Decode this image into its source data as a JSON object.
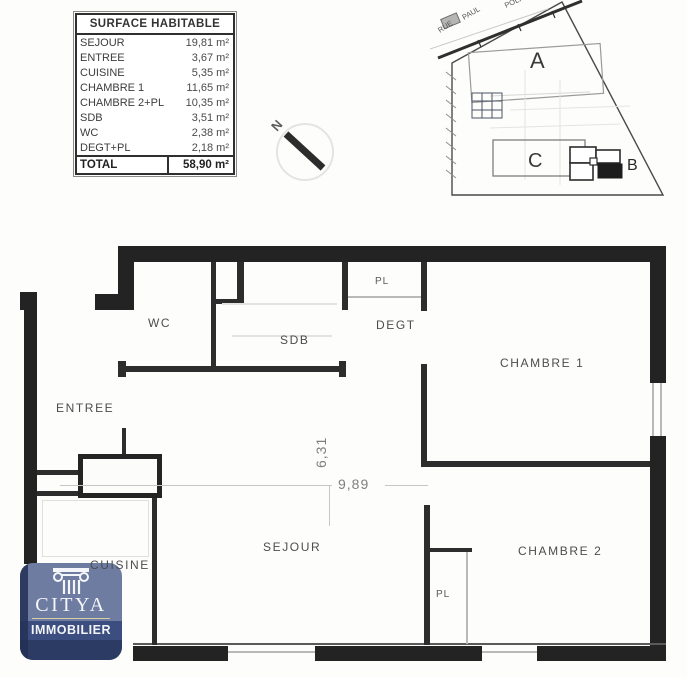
{
  "surface_table": {
    "title": "SURFACE HABITABLE",
    "rows": [
      {
        "label": "SEJOUR",
        "value": "19,81 m²"
      },
      {
        "label": "ENTREE",
        "value": "3,67 m²"
      },
      {
        "label": "CUISINE",
        "value": "5,35 m²"
      },
      {
        "label": "CHAMBRE 1",
        "value": "11,65 m²"
      },
      {
        "label": "CHAMBRE 2+PL",
        "value": "10,35 m²"
      },
      {
        "label": "SDB",
        "value": "3,51 m²"
      },
      {
        "label": "WC",
        "value": "2,38 m²"
      },
      {
        "label": "DEGT+PL",
        "value": "2,18 m²"
      }
    ],
    "total": {
      "label": "TOTAL",
      "value": "58,90 m²"
    }
  },
  "site_plan": {
    "street_words": {
      "w1": "RUE",
      "w2": "PAUL",
      "w3": "POLIO"
    },
    "building_labels": {
      "a": "A",
      "b": "B",
      "c": "C"
    }
  },
  "compass": {
    "north": "N"
  },
  "floor_plan": {
    "labels": {
      "wc": "WC",
      "sdb": "SDB",
      "pl_top": "PL",
      "degt": "DEGT",
      "chambre1": "CHAMBRE 1",
      "entree": "ENTREE",
      "sejour": "SEJOUR",
      "chambre2": "CHAMBRE 2",
      "cuisine": "CUISINE",
      "pl_bottom": "PL"
    },
    "dimensions": {
      "vertical": "6,31",
      "horizontal": "9,89"
    }
  },
  "logo": {
    "brand": "CITYA",
    "tagline": "IMMOBILIER",
    "colors": {
      "badge": "#6f7ca1",
      "band": "#3c4e7f",
      "edge": "#233055",
      "divider": "#d6cfa0"
    }
  }
}
